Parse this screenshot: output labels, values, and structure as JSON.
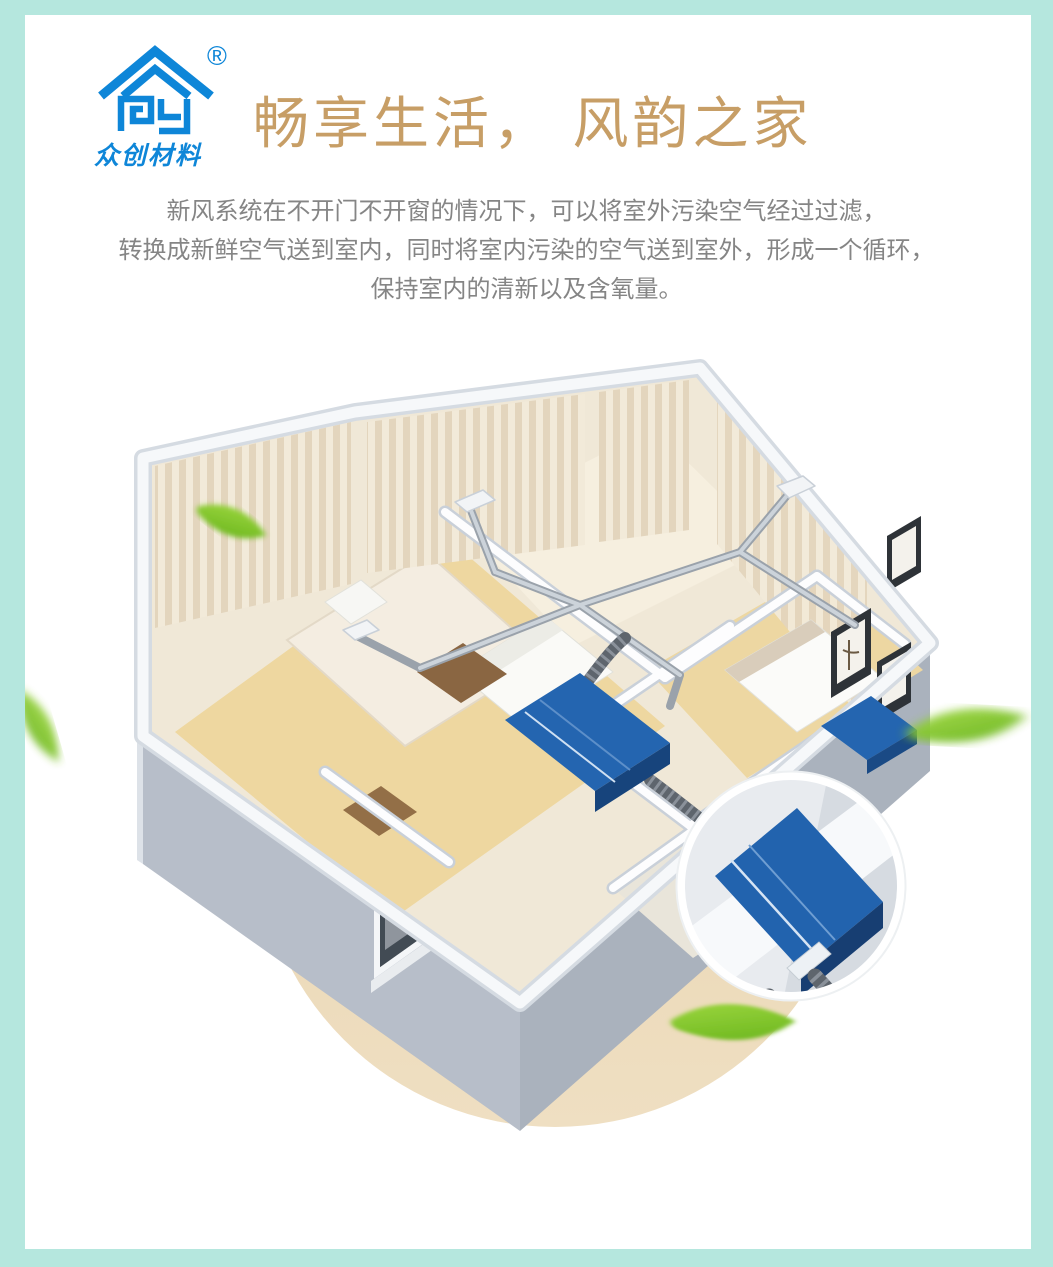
{
  "page": {
    "background_color": "#ffffff",
    "frame_color": "#b5e7de"
  },
  "logo": {
    "brand_text": "众创材料",
    "registered_mark": "®",
    "color": "#0e86d8",
    "icon": "house-logo-icon"
  },
  "header": {
    "title": "畅享生活， 风韵之家",
    "title_color": "#c79e66"
  },
  "description": {
    "color": "#858585",
    "lines": [
      "新风系统在不开门不开窗的情况下，可以将室外污染空气经过过滤，",
      "转换成新鲜空气送到室内，同时将室内污染的空气送到室外，形成一个循环，",
      "保持室内的清新以及含氧量。"
    ]
  },
  "illustration": {
    "subject": "fresh-air-ventilation-system-apartment-cutaway",
    "elements": [
      "isometric-apartment-cutaway",
      "ceiling-duct-network",
      "blue-hrv-unit",
      "magnifier-detail-of-hrv-unit",
      "green-leaves",
      "tan-backdrop-circle"
    ],
    "accent_colors": {
      "hrv_unit_blue": "#2263ae",
      "duct_silver": "#a7aeb7",
      "flex_duct_gray": "#5e656d",
      "wood_floor": "#eed7a0",
      "exterior_wall_gray": "#b3bac4",
      "backdrop_circle_tan": "#e9d5b2",
      "leaf_green": "#6fbf23"
    }
  }
}
